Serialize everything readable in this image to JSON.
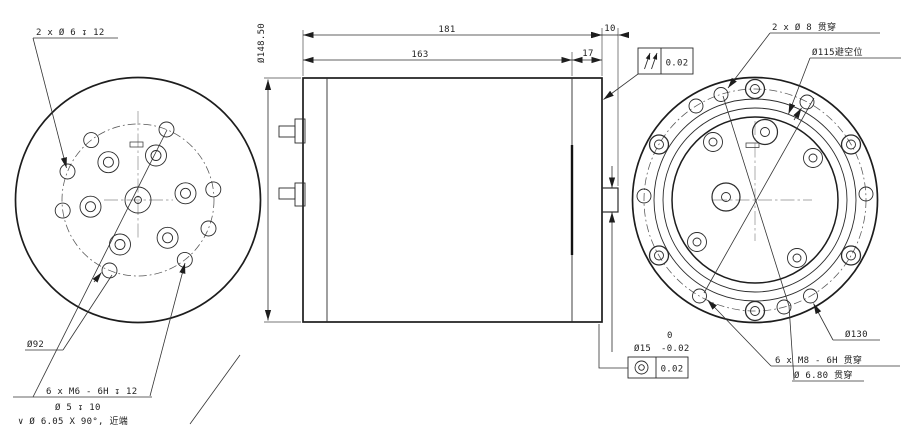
{
  "views": {
    "front": {
      "callout_holes_top": "2 x Ø 6 ↧ 12",
      "callout_bolt_circle": "Ø92",
      "callout_m6_1": "6 x M6 - 6H ↧ 12",
      "callout_m6_2": "Ø 5 ↧ 10",
      "callout_m6_3": "∨ Ø 6.05 X 90°, 近端"
    },
    "side": {
      "dim_outer_dia": "Ø148.50",
      "dim_total_len": "181",
      "dim_body_len": "163",
      "dim_cap_len": "17",
      "dim_end_len": "10",
      "parallelism_value": "0.02",
      "shaft_dia": "Ø15",
      "shaft_tol_upper": "0",
      "shaft_tol_lower": "-0.02",
      "concentricity_value": "0.02"
    },
    "rear": {
      "callout_d8": "2 x Ø 8 贯穿",
      "callout_d115": "Ø115避空位",
      "callout_d130": "Ø130",
      "callout_m8_1": "6 x M8 - 6H 贯穿",
      "callout_m8_2": "Ø 6.80 贯穿"
    }
  }
}
